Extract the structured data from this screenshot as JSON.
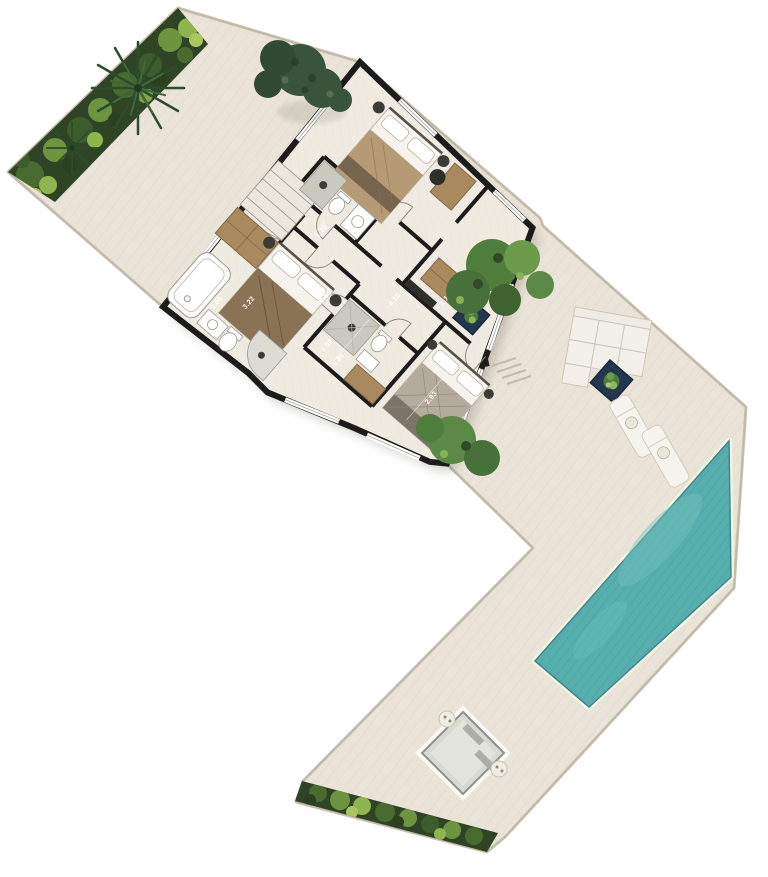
{
  "colors": {
    "deck": "#e9e3d8",
    "deck_edge": "#cbc3b2",
    "pool": "#56afad",
    "pool_coping": "#f6f3ea",
    "hedge": "#2f4425",
    "wall": "#1c1c1c",
    "floor": "#f0ebe1",
    "planter_navy": "#24374f",
    "furniture_brown": "#a98a5f",
    "fixture_grey": "#c9c9c0"
  },
  "dims": {
    "bath_main_width": "2.06",
    "bath_main_length": "3.22",
    "hall_width": "1.20",
    "hall_length": "2.31",
    "shower_room_width": "1.50",
    "shower_room_length": "1.80",
    "dressing_length": "4.10",
    "dressing_width": "1.10",
    "bedroom_width": "2.93"
  }
}
